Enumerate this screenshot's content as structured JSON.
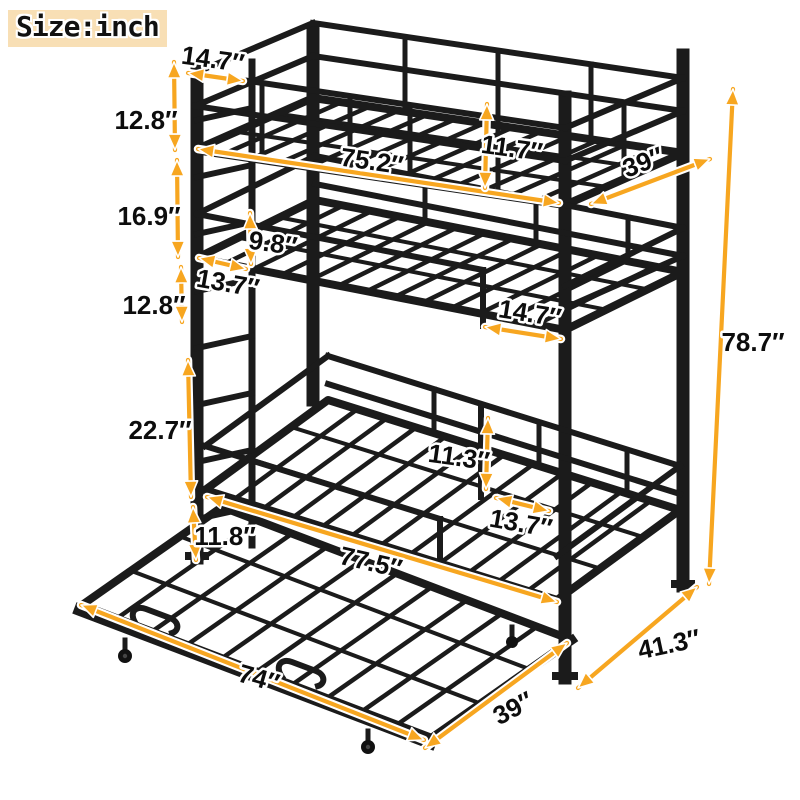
{
  "badge": {
    "label": "Size:inch"
  },
  "unit": "inch",
  "colors": {
    "arrow": "#F7A620",
    "metal": "#1b1b1b",
    "badge_bg": "#F8DFB5",
    "label_text": "#0d0d0d"
  },
  "dimensions": {
    "top_rail_section_width": {
      "label": "14.7″",
      "value": 14.7
    },
    "top_guardrail_height": {
      "label": "12.8″",
      "value": 12.8
    },
    "top_to_middle_gap": {
      "label": "16.9″",
      "value": 16.9
    },
    "middle_rail_height": {
      "label": "12.8″",
      "value": 12.8
    },
    "middle_to_bottom_gap": {
      "label": "22.7″",
      "value": 22.7
    },
    "trundle_clearance_height": {
      "label": "11.8″",
      "value": 11.8
    },
    "middle_guardrail_height": {
      "label": "9.8″",
      "value": 9.8
    },
    "middle_ladder_gap": {
      "label": "13.7″",
      "value": 13.7
    },
    "top_bunk_length": {
      "label": "75.2″",
      "value": 75.2
    },
    "top_rail_above_deck": {
      "label": "11.7″",
      "value": 11.7
    },
    "top_bunk_width": {
      "label": "39″",
      "value": 39
    },
    "middle_rail_section_width": {
      "label": "14.7″",
      "value": 14.7
    },
    "bottom_clearance_height": {
      "label": "11.3″",
      "value": 11.3
    },
    "bottom_ladder_gap": {
      "label": "13.7″",
      "value": 13.7
    },
    "bottom_bunk_length": {
      "label": "77.5″",
      "value": 77.5
    },
    "trundle_length": {
      "label": "74″",
      "value": 74
    },
    "trundle_width": {
      "label": "39″",
      "value": 39
    },
    "overall_depth": {
      "label": "41.3″",
      "value": 41.3
    },
    "overall_height": {
      "label": "78.7″",
      "value": 78.7
    }
  }
}
